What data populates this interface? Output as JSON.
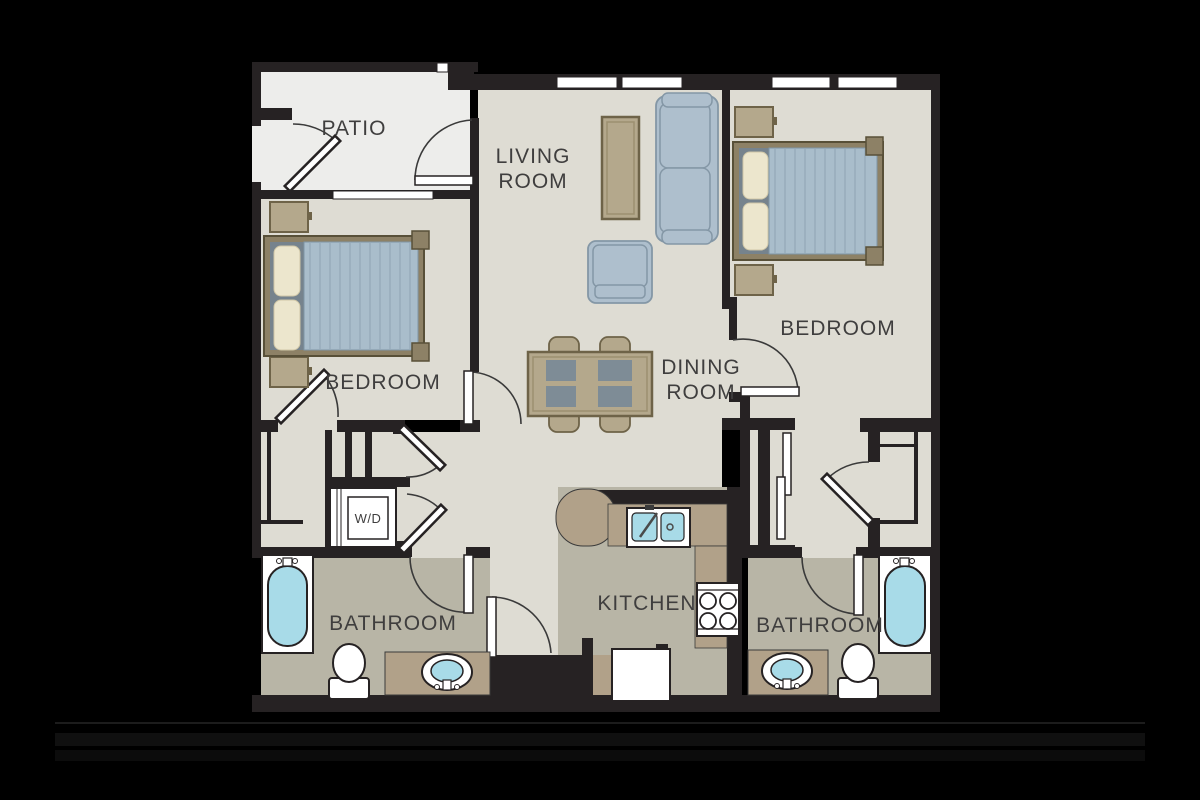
{
  "plan": {
    "type": "apartment-floor-plan",
    "rooms": {
      "patio": {
        "label": "PATIO"
      },
      "living_room": {
        "label_line1": "LIVING",
        "label_line2": "ROOM"
      },
      "bedroom_left": {
        "label": "BEDROOM"
      },
      "bedroom_right": {
        "label": "BEDROOM"
      },
      "dining_room": {
        "label_line1": "DINING",
        "label_line2": "ROOM"
      },
      "kitchen": {
        "label": "KITCHEN"
      },
      "bathroom_left": {
        "label": "BATHROOM"
      },
      "bathroom_right": {
        "label": "BATHROOM"
      },
      "laundry_closet": {
        "label": "W/D"
      }
    },
    "furniture_glyphs": [
      "queen-bed-with-headboard-and-posts",
      "nightstand",
      "sofa",
      "armchair",
      "coffee-table",
      "dining-table-four-chairs",
      "kitchen-double-sink",
      "stove-four-burners",
      "refrigerator",
      "bathtub",
      "toilet",
      "vanity-sink",
      "stacked-washer-dryer",
      "sliding-closet-doors",
      "swing-door-with-arc",
      "window"
    ],
    "colors": {
      "background": "#000000",
      "wall": "#262223",
      "floor_main": "#dedcd3",
      "floor_patio": "#ededeb",
      "floor_wet": "#b8b5a6",
      "counter_tan": "#b1a189",
      "furniture_tan": "#b4a88c",
      "furniture_tan_dark": "#6e6348",
      "upholstery_blue": "#aebfcd",
      "upholstery_blue_dark": "#8497a6",
      "headboard_gray": "#76838d",
      "mattress_blue": "#a9bdcb",
      "pillow_cream": "#ece6cd",
      "water_blue": "#a8dbe8",
      "fixture_white": "#ffffff",
      "label_text": "#3f3e3e"
    }
  }
}
